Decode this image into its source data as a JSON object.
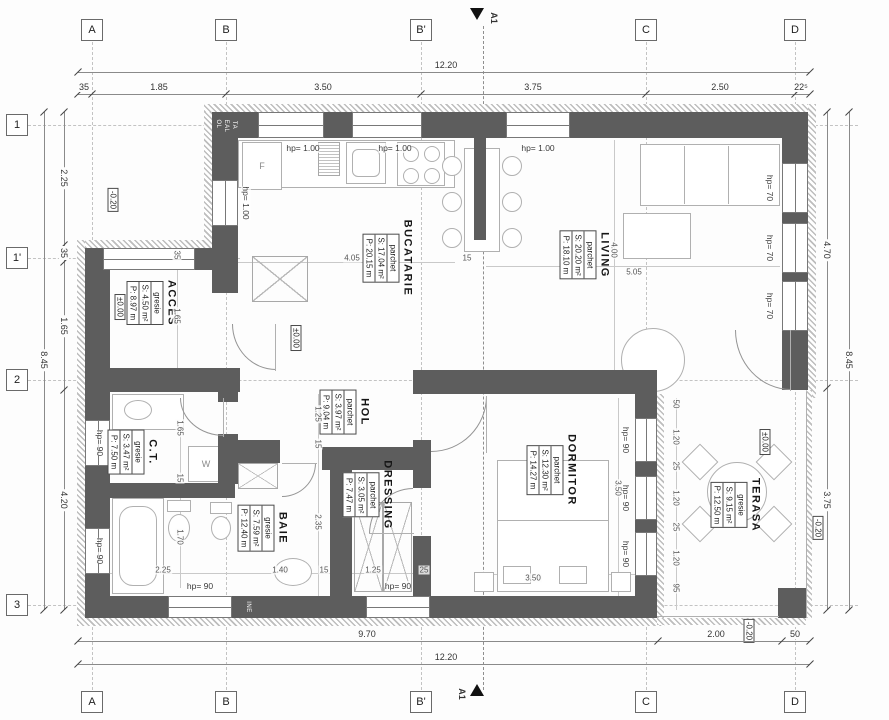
{
  "grid": {
    "top": [
      "A",
      "B",
      "B'",
      "C",
      "D"
    ],
    "bottom": [
      "A",
      "B",
      "B'",
      "C",
      "D"
    ],
    "left": [
      "1",
      "1'",
      "2",
      "3"
    ]
  },
  "section": {
    "label": "A1"
  },
  "dims": {
    "top_total": "12.20",
    "top": [
      "35",
      "1.85",
      "3.50",
      "3.75",
      "2.50",
      "22⁵"
    ],
    "bottom": [
      "9.70",
      "2.00",
      "50"
    ],
    "bottom_total": "12.20",
    "left_total": "8.45",
    "left": [
      "2.25",
      "35",
      "1.65",
      "4.20"
    ],
    "right": [
      "4.70",
      "3.75"
    ],
    "right_total": "8.45"
  },
  "interior_dims": {
    "kitchen_w": "4.05",
    "fin": "15",
    "living_h": "4.00",
    "living_w": "5.05",
    "acces_wall": "35",
    "acces_w": "1.65",
    "hol_w": "1.25",
    "hol_wall": "15",
    "dressing_h": "2.35",
    "ct_h1": "1.65",
    "ct_wall": "15",
    "ct_h2": "1.70",
    "baie_w1": "2.25",
    "baie_w2": "1.40",
    "baie_wall": "15",
    "dressing_w": "1.25",
    "dressing_wall": "25",
    "dorm_h": "3.50",
    "dorm_w": "3.50",
    "terasa": [
      "50",
      "1.20",
      "25",
      "1.20",
      "25",
      "1.20",
      "95"
    ]
  },
  "levels": {
    "zero": "±0.00",
    "minus": "-0.20"
  },
  "openings": {
    "hp100": "hp= 1.00",
    "hp90": "hp= 90",
    "hp70": "hp= 70"
  },
  "rooms": {
    "acces": {
      "name": "ACCES",
      "finish": "gresie",
      "area": "S: 4.50 m²",
      "per": "P: 8.97 m"
    },
    "bucatarie": {
      "name": "BUCATARIE",
      "finish": "parchet",
      "area": "S: 17.04 m²",
      "per": "P: 20.15 m"
    },
    "living": {
      "name": "LIVING",
      "finish": "parchet",
      "area": "S: 20.20 m²",
      "per": "P: 18.10 m"
    },
    "hol": {
      "name": "HOL",
      "finish": "parchet",
      "area": "S: 3.97 m²",
      "per": "P: 9.04 m"
    },
    "ct": {
      "name": "C.T.",
      "finish": "gresie",
      "area": "S: 3.47 m²",
      "per": "P: 7.50 m"
    },
    "baie": {
      "name": "BAIE",
      "finish": "gresie",
      "area": "S: 7.59 m²",
      "per": "P: 12.40 m"
    },
    "dressing": {
      "name": "DRESSING",
      "finish": "parchet",
      "area": "S: 3.05 m²",
      "per": "P: 7.47 m"
    },
    "dormitor": {
      "name": "DORMITOR",
      "finish": "parchet",
      "area": "S: 12.30 m²",
      "per": "P: 14.27 m"
    },
    "terasa": {
      "name": "TERASA",
      "finish": "gresie",
      "area": "S: 9.15 m²",
      "per": "P: 12.50 m"
    }
  },
  "furniture": {
    "fridge": "F",
    "washer": "W"
  },
  "wall_texts": [
    "OL",
    "EAL",
    "TA",
    "INE"
  ]
}
